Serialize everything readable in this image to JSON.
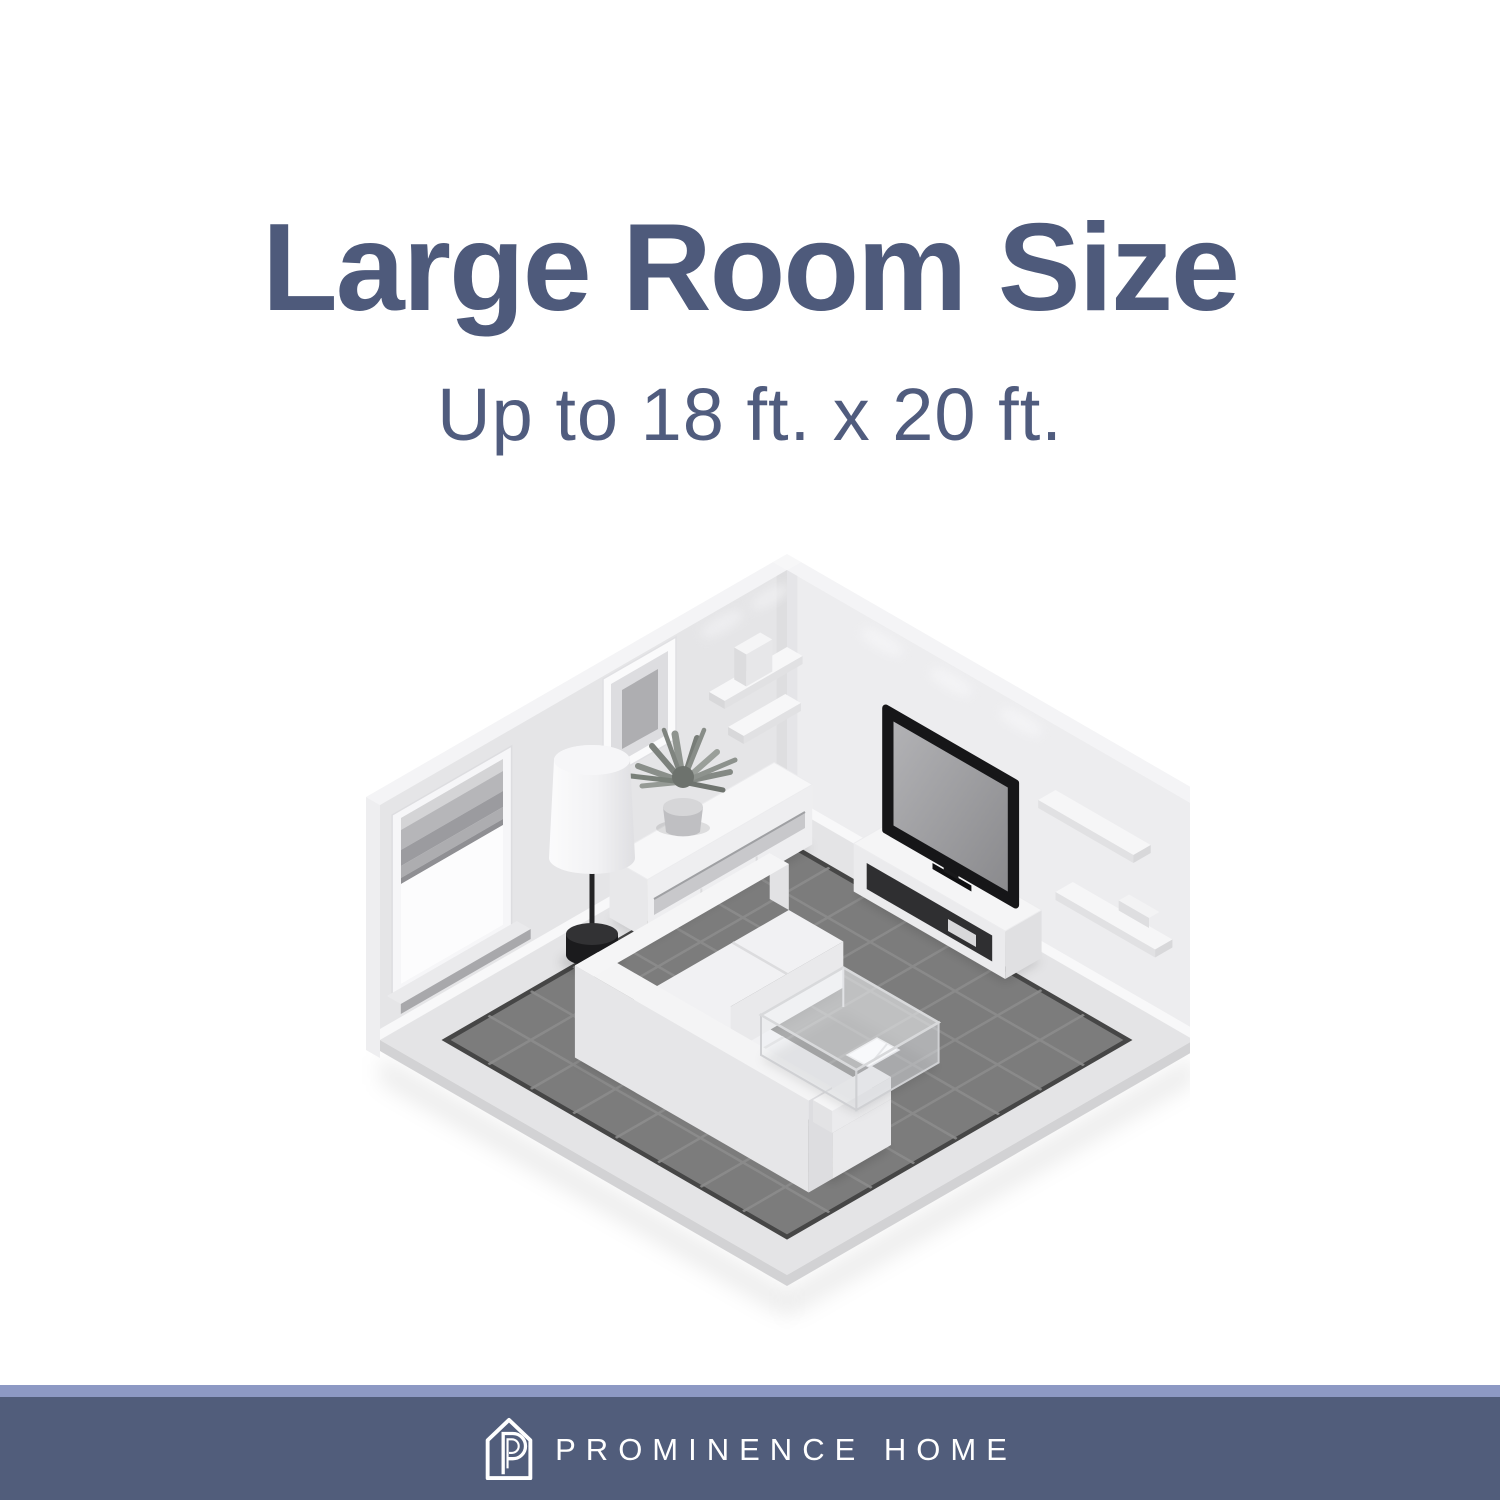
{
  "page": {
    "background_color": "#ffffff"
  },
  "header": {
    "title": "Large Room Size",
    "subtitle": "Up to 18 ft. x 20 ft.",
    "text_color": "#4e5a7b"
  },
  "illustration": {
    "name": "isometric-living-room",
    "description": "Grayscale isometric living room showing maximum room size: L-shaped white sofa, glass coffee table with magazine, flat-screen TV on media stand, sideboard with potted plant, floor lamp, window with blinds, framed picture, wall shelves with speaker box, dark gray tiled area rug",
    "room_max_size": "18 ft. x 20 ft.",
    "colors": {
      "wall_left": "#e5e5e7",
      "wall_right": "#ededef",
      "rug": "#7c7c7c",
      "rug_grid": "#8e8e8e",
      "rug_rim": "#464646",
      "floor_border": "#e4e4e6",
      "furniture_white": "#f3f3f4",
      "tv_frame": "#161618",
      "tv_screen": "#9c9c9f",
      "lamp_dark": "#1b1b1d",
      "plant": "#8a8f8a"
    }
  },
  "footer": {
    "brand": "PROMINENCE HOME",
    "logo": "prominence-home-house-p-icon",
    "accent_strip_color": "#8d99c4",
    "band_color": "#515d7b",
    "text_color": "#ffffff"
  }
}
